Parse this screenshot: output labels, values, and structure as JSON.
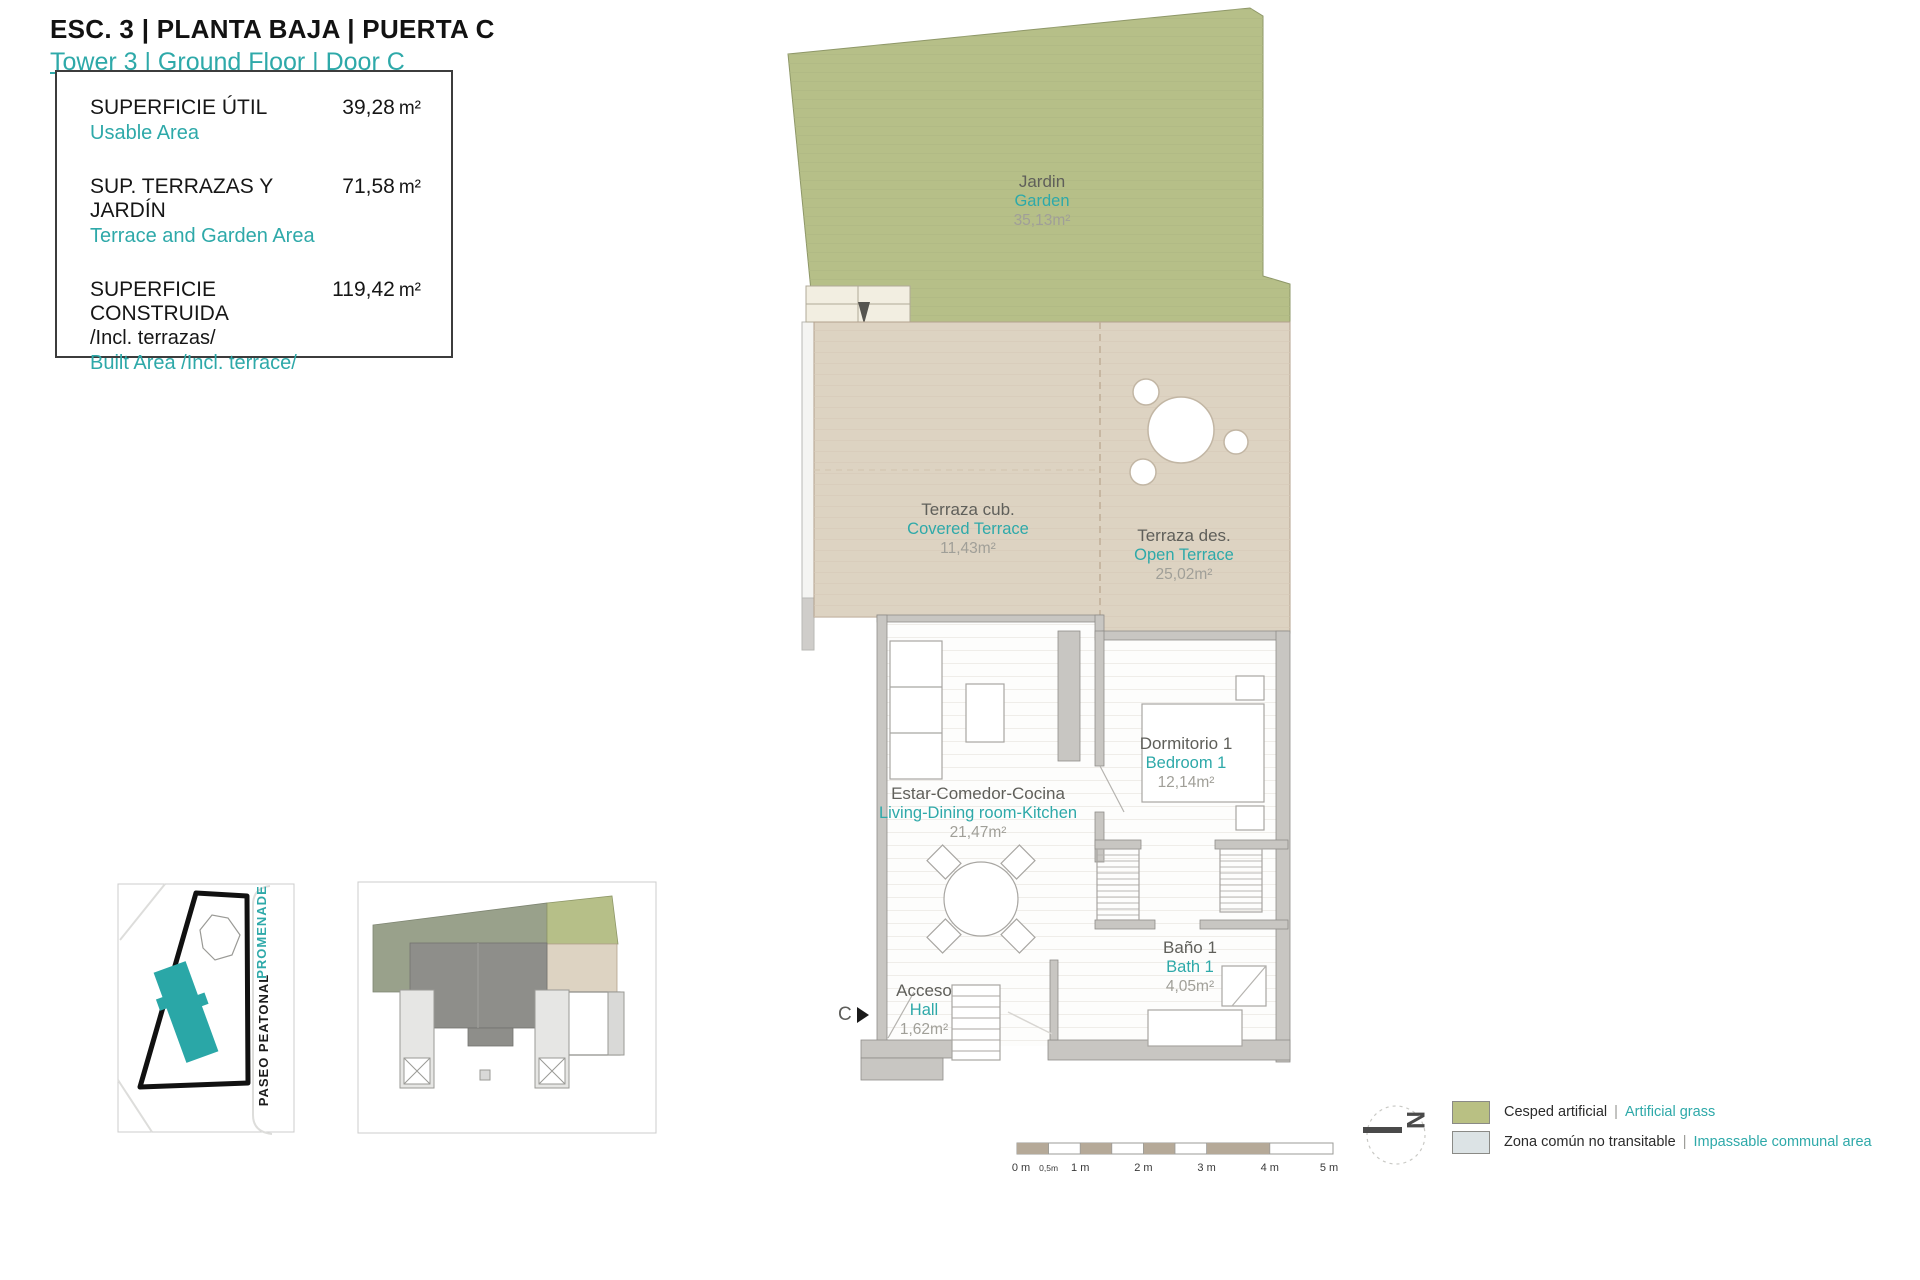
{
  "header": {
    "title": "ESC. 3 | PLANTA BAJA | PUERTA C",
    "subtitle": "Tower 3 | Ground Floor | Door C"
  },
  "summary": {
    "rows": [
      {
        "label": "SUPERFICIE ÚTIL",
        "label_en": "Usable Area",
        "value": "39,28",
        "unit": "m²"
      },
      {
        "label": "SUP. TERRAZAS Y JARDÍN",
        "label_en": "Terrace and Garden Area",
        "value": "71,58",
        "unit": "m²"
      },
      {
        "label": "SUPERFICIE CONSTRUIDA",
        "label_note": "/Incl. terrazas/",
        "label_en": "Built Area /Incl. terrace/",
        "value": "119,42",
        "unit": "m²"
      }
    ]
  },
  "rooms": [
    {
      "name_es": "Jardin",
      "name_en": "Garden",
      "area": "35,13m²"
    },
    {
      "name_es": "Terraza cub.",
      "name_en": "Covered Terrace",
      "area": "11,43m²"
    },
    {
      "name_es": "Terraza des.",
      "name_en": "Open Terrace",
      "area": "25,02m²"
    },
    {
      "name_es": "Estar-Comedor-Cocina",
      "name_en": "Living-Dining room-Kitchen",
      "area": "21,47m²"
    },
    {
      "name_es": "Dormitorio 1",
      "name_en": "Bedroom 1",
      "area": "12,14m²"
    },
    {
      "name_es": "Baño 1",
      "name_en": "Bath 1",
      "area": "4,05m²"
    },
    {
      "name_es": "Acceso",
      "name_en": "Hall",
      "area": "1,62m²"
    }
  ],
  "entrance": {
    "label": "C"
  },
  "site_map": {
    "promenade": "PROMENADE",
    "paseo": "PASEO PEATONAL"
  },
  "scale_bar": {
    "labels": [
      "0 m",
      "0,5m",
      "1 m",
      "2 m",
      "3 m",
      "4 m",
      "5 m"
    ]
  },
  "compass": {
    "north": "N"
  },
  "legend": [
    {
      "es": "Cesped artificial",
      "en": "Artificial grass",
      "divider": "|",
      "color": "#b9c083"
    },
    {
      "es": "Zona común no transitable",
      "en": "Impassable communal area",
      "divider": "|",
      "color": "#dce3e5"
    }
  ],
  "colors": {
    "accent": "#2ea9a9",
    "garden": "#b6bf88",
    "terrace": "#ddd3c2",
    "wall": "#c8c6c2",
    "keyplan_other_garden": "#99a18b",
    "keyplan_other_unit": "#8e8e8a",
    "site_building": "#2aa7a7",
    "scale_fill": "#b5a998"
  }
}
